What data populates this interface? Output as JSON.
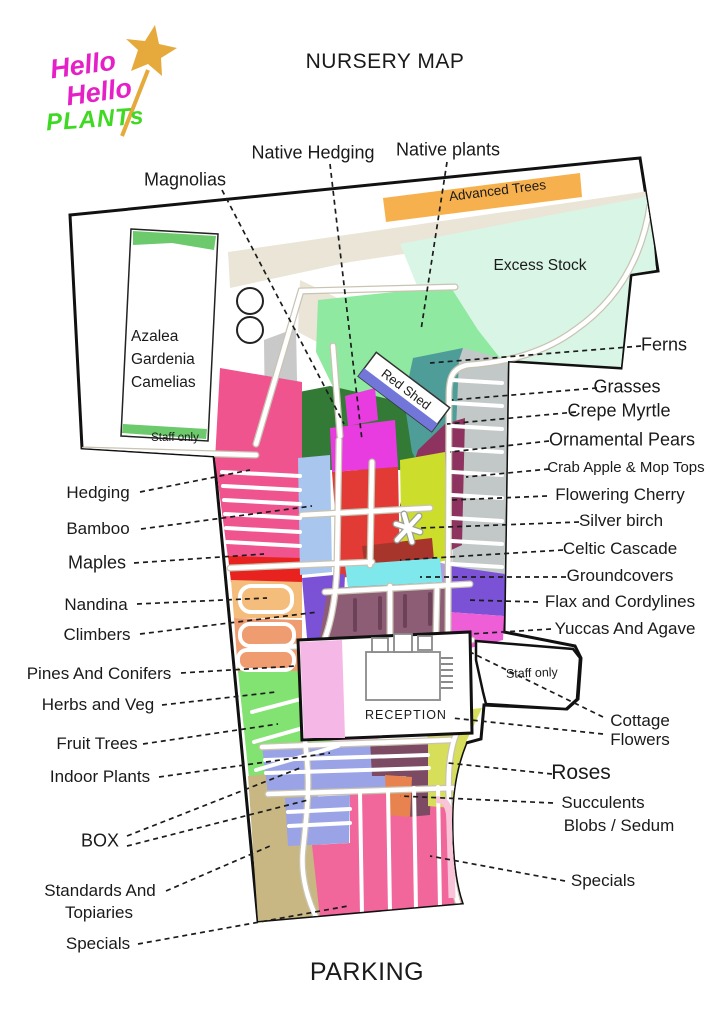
{
  "title": "NURSERY MAP",
  "parking": "PARKING",
  "logo": {
    "hello1": "Hello",
    "hello2": "Hello",
    "plants": "PLANTs"
  },
  "inner": {
    "advanced_trees": "Advanced Trees",
    "excess_stock": "Excess Stock",
    "azalea1": "Azalea",
    "azalea2": "Gardenia",
    "azalea3": "Camelias",
    "staff_top": "Staff only",
    "staff_right": "Staff only",
    "red_shed": "Red Shed",
    "reception": "RECEPTION"
  },
  "labels": {
    "magnolias": "Magnolias",
    "native_hedging": "Native Hedging",
    "native_plants": "Native plants",
    "ferns": "Ferns",
    "grasses": "Grasses",
    "crepe_myrtle": "Crepe Myrtle",
    "ornamental_pears": "Ornamental Pears",
    "crab_apple": "Crab Apple & Mop Tops",
    "flowering_cherry": "Flowering Cherry",
    "silver_birch": "Silver birch",
    "celtic_cascade": "Celtic Cascade",
    "groundcovers": "Groundcovers",
    "flax": "Flax and Cordylines",
    "yuccas": "Yuccas And Agave",
    "cottage1": "Cottage",
    "cottage2": "Flowers",
    "roses": "Roses",
    "succulents1": "Succulents",
    "succulents2": "Blobs / Sedum",
    "specials_right": "Specials",
    "hedging": "Hedging",
    "bamboo": "Bamboo",
    "maples": "Maples",
    "nandina": "Nandina",
    "climbers": "Climbers",
    "pines": "Pines And Conifers",
    "herbs": "Herbs and Veg",
    "fruit_trees": "Fruit Trees",
    "indoor_plants": "Indoor Plants",
    "box": "BOX",
    "standards1": "Standards And",
    "standards2": "Topiaries",
    "specials_left": "Specials"
  },
  "colors": {
    "beige_path": "#eae5d6",
    "advanced_trees": "#f6b14e",
    "excess_stock": "#d9f5e6",
    "native_green": "#8fe9a0",
    "dark_green": "#337a36",
    "mid_green": "#58bd60",
    "gray_strip": "#c9c9c9",
    "hedging_pink": "#f0548e",
    "maples_red": "#e8231f",
    "nandina_orange": "#f4bd7c",
    "climbers_salmon": "#ef9d70",
    "pines_green": "#82e272",
    "standards_tan": "#c9b783",
    "bamboo_blue": "#a9c6ee",
    "center_red": "#e23a34",
    "magenta": "#e93ce0",
    "chartreuse": "#ccdd2b",
    "teal": "#4f9d98",
    "maroon": "#8e3360",
    "celtic_red": "#a8352c",
    "cyan": "#7fe8ec",
    "plum": "#8d5d76",
    "flax_purple": "#7b52d6",
    "lavender": "#b39ddb",
    "yucca_magenta": "#ee5fd7",
    "grasses_gray": "#c2c8c8",
    "box_periwinkle": "#9aa3e6",
    "specials_pink": "#f2679b",
    "specials_lightpink": "#f9c4d8",
    "bottom_maroon": "#7d4a63",
    "succulent_orange": "#e8824e",
    "roses_yellow": "#d6de5a",
    "shed_blue": "#7276d8",
    "reception_pink": "#f5b8e6",
    "indoor_pink": "#f2c6ea",
    "azalea_green": "#6cc96c",
    "slate_block": "#4f5d54",
    "logo_pink": "#e520c6",
    "logo_green": "#3fd823",
    "logo_gold": "#e6a93c"
  }
}
